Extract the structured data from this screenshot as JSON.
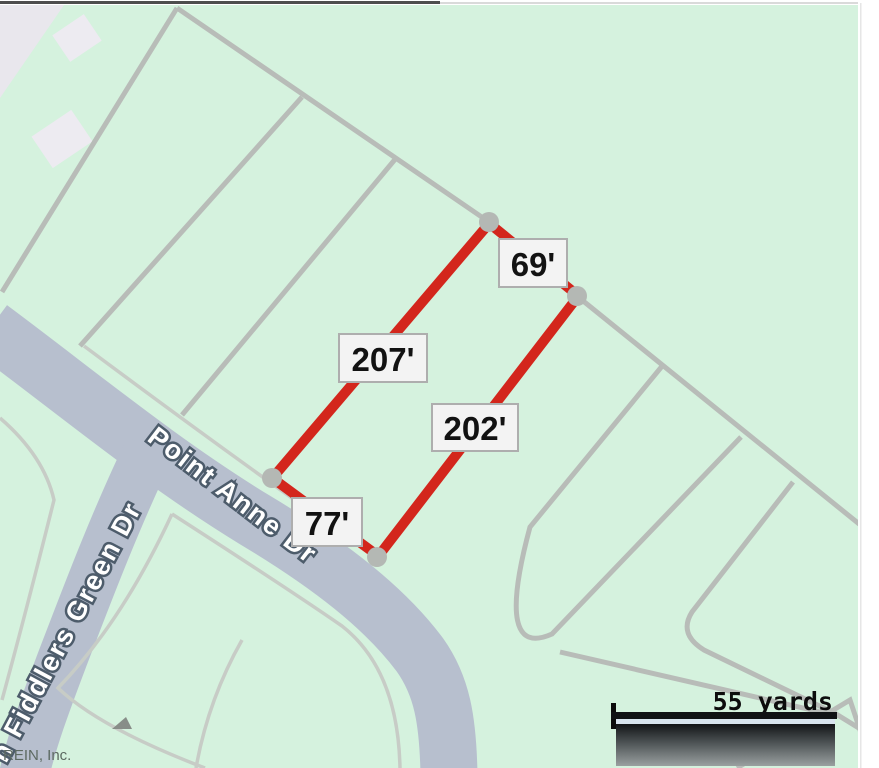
{
  "map": {
    "type": "parcel-plat-map",
    "measurements": [
      {
        "name": "rear-lot-line",
        "label": "69'"
      },
      {
        "name": "northwest-lot-line",
        "label": "207'"
      },
      {
        "name": "southeast-lot-line",
        "label": "202'"
      },
      {
        "name": "front-lot-line",
        "label": "77'"
      }
    ],
    "streets": [
      {
        "name": "point-anne-dr",
        "label": "Point Anne Dr"
      },
      {
        "name": "fiddlers-green-dr",
        "label": "n Fiddlers Green Dr"
      }
    ],
    "scale_bar": {
      "label": "55 yards"
    },
    "attribution": "REIN, Inc.",
    "colors": {
      "land": "#d5f2de",
      "road": "#b7bfce",
      "parcel_line": "#b8bcb8",
      "front_line": "#c7ccc6",
      "highlight_red": "#d3261c",
      "vertex_gray": "#b4b8b4",
      "label_box_bg": "#f3f3f3",
      "label_box_border": "#aeaeae"
    }
  }
}
